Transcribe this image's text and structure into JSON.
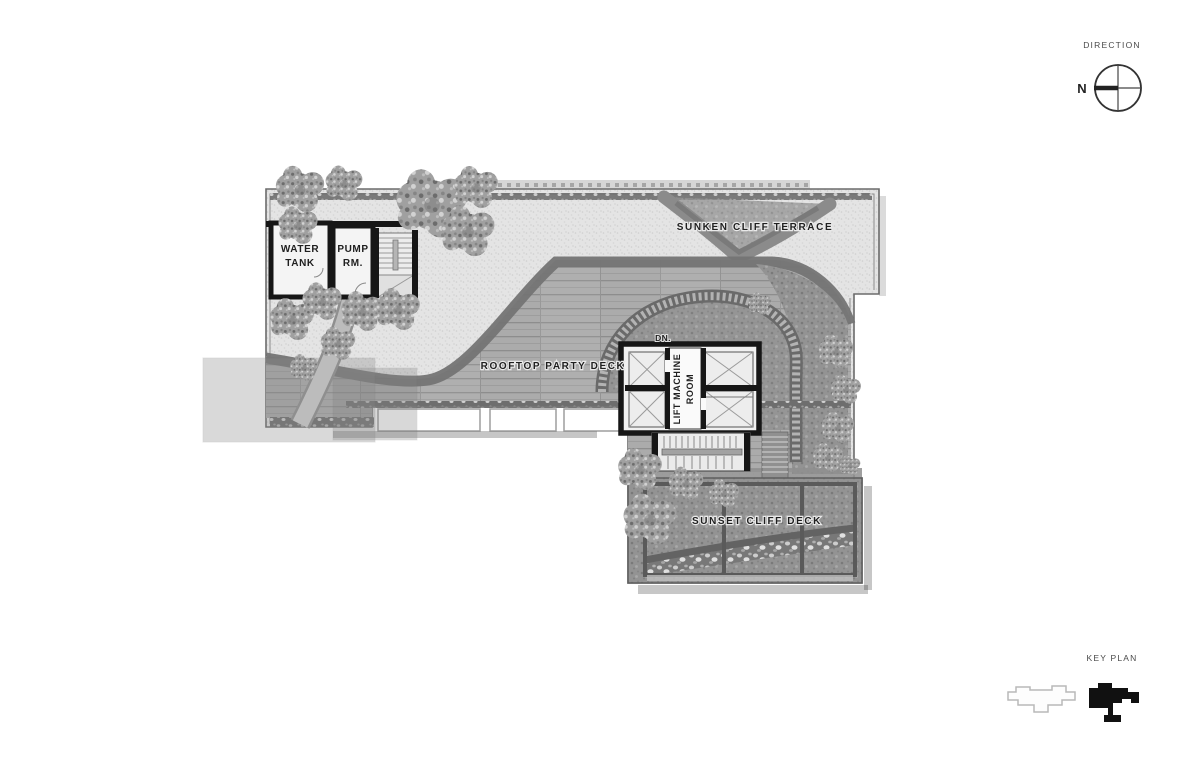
{
  "drawing": {
    "type": "rooftop-floor-plan"
  },
  "direction": {
    "label": "DIRECTION",
    "north": "N"
  },
  "key_plan": {
    "label": "KEY PLAN"
  },
  "rooms": {
    "water_tank": {
      "line1": "WATER",
      "line2": "TANK"
    },
    "pump_room": {
      "line1": "PUMP",
      "line2": "RM."
    },
    "lift_machine_room": {
      "line1": "LIFT MACHINE",
      "line2": "ROOM"
    },
    "down": "DN."
  },
  "areas": {
    "sunken_cliff_terrace": "SUNKEN CLIFF TERRACE",
    "rooftop_party_deck": "ROOFTOP PARTY DECK",
    "sunset_cliff_deck": "SUNSET CLIFF DECK"
  },
  "colors": {
    "paper": "#ffffff",
    "ink": "#1a1a1a",
    "wall": "#161616",
    "room_fill": "#f4f4f4",
    "stipple_base": "#e4e4e4",
    "deck_base": "#ababab",
    "curve_band": "#747474",
    "garden": "#8f8f8f",
    "keyplan_fill": "#111111"
  }
}
